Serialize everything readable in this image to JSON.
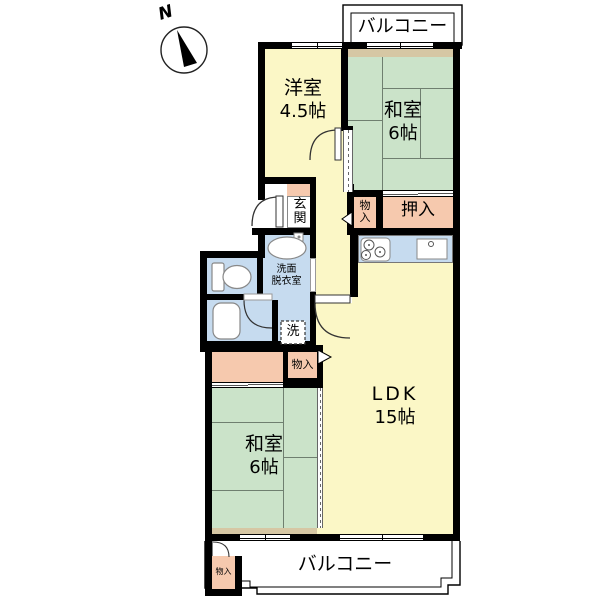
{
  "compass": {
    "north_label": "N"
  },
  "balcony_top": {
    "label": "バルコニー"
  },
  "balcony_bottom": {
    "label": "バルコニー"
  },
  "rooms": {
    "western_room": {
      "name": "洋室",
      "size": "4.5帖"
    },
    "japanese_room_upper": {
      "name": "和室",
      "size": "6帖"
    },
    "japanese_room_lower": {
      "name": "和室",
      "size": "6帖"
    },
    "ldk": {
      "name": "LDK",
      "size": "15帖"
    },
    "entrance": {
      "label": "玄関"
    },
    "closet_oshiire": {
      "label": "押入"
    },
    "storage_upper": {
      "label": "物入"
    },
    "storage_middle": {
      "label": "物入"
    },
    "storage_balcony": {
      "label": "物入"
    },
    "washroom": {
      "line1": "洗面",
      "line2": "脱衣室"
    },
    "washer": {
      "label": "洗"
    }
  },
  "colors": {
    "room_yellow": "#FBF7C6",
    "tatami_green": "#CBE3C9",
    "closet_pink": "#F6C9AE",
    "wet_blue": "#C6DBEF",
    "ledge_tan": "#D6C7A4",
    "wall_black": "#000000"
  }
}
